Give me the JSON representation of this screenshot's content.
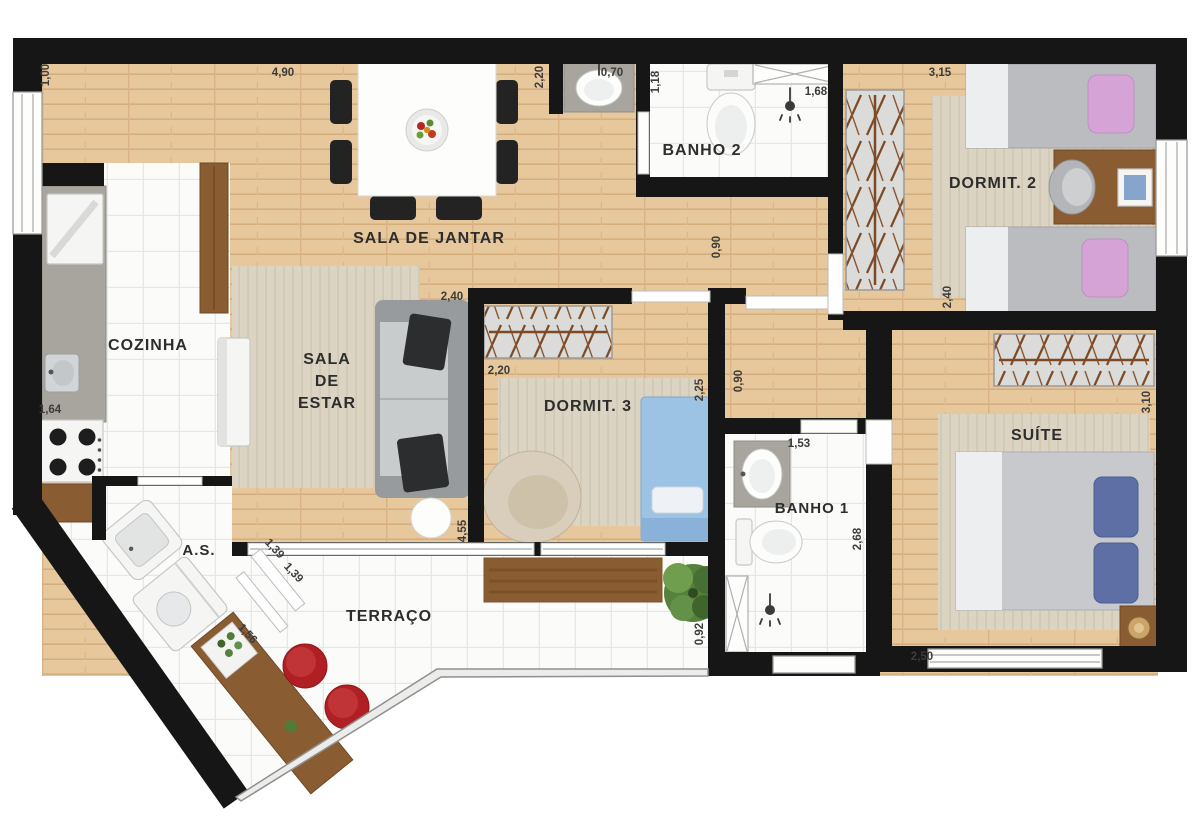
{
  "plan_title": "Apartment floor plan",
  "rooms": {
    "dining": {
      "label": "SALA DE JANTAR"
    },
    "kitchen": {
      "label": "COZINHA"
    },
    "living": {
      "l1": "SALA",
      "l2": "DE",
      "l3": "ESTAR"
    },
    "bath2": {
      "label": "BANHO 2"
    },
    "bedroom2": {
      "label": "DORMIT. 2"
    },
    "bedroom3": {
      "label": "DORMIT. 3"
    },
    "bath1": {
      "label": "BANHO 1"
    },
    "suite": {
      "label": "SUÍTE"
    },
    "service": {
      "label": "A.S."
    },
    "terrace": {
      "label": "TERRAÇO"
    }
  },
  "dimensions": {
    "d_1_00": "1,00",
    "d_4_90": "4,90",
    "d_2_20a": "2,20",
    "d_0_70": "0,70",
    "d_1_18": "1,18",
    "d_1_68": "1,68",
    "d_3_15": "3,15",
    "d_0_90a": "0,90",
    "d_2_40a": "2,40",
    "d_2_40b": "2,40",
    "d_2_20b": "2,20",
    "d_2_25": "2,25",
    "d_0_90b": "0,90",
    "d_3_10": "3,10",
    "d_1_64": "1,64",
    "d_1_53": "1,53",
    "d_2_68": "2,68",
    "d_4_55": "4,55",
    "d_1_39a": "1,39",
    "d_1_39b": "1,39",
    "d_1_56": "1,56",
    "d_0_92": "0,92",
    "d_2_50": "2,50"
  },
  "colors": {
    "wall": "#161616",
    "wood_floor": "#e7c89d",
    "tile": "#fbfbf9",
    "rug": "#dcd4c3",
    "accent_red": "#b01f24",
    "pillow_pink": "#d6a3d6",
    "pillow_blue": "#5d6fa5",
    "bed_blue": "#9cc2e4",
    "furniture_wood": "#8a5c32"
  }
}
